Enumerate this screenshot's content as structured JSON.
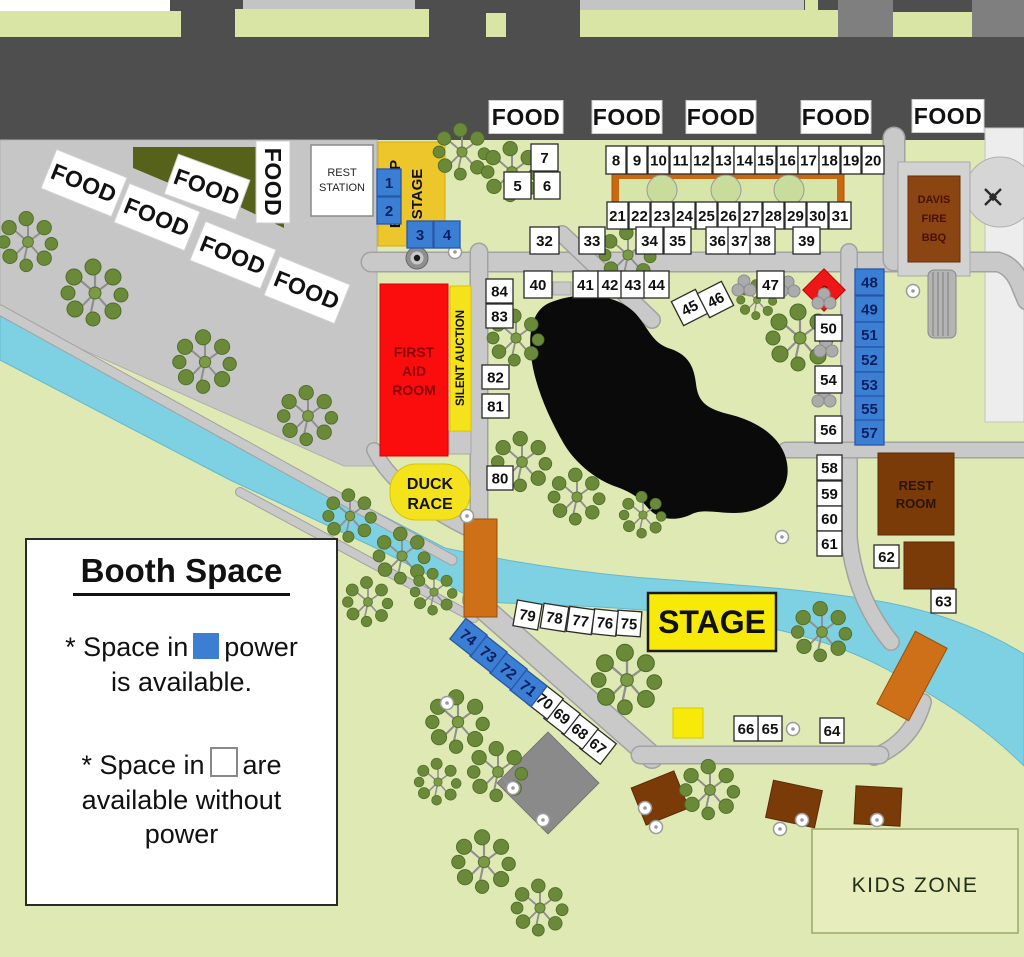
{
  "labels": {
    "food": "FOOD",
    "rest_station_1": "REST",
    "rest_station_2": "STATION",
    "backup_1": "BACK UP",
    "backup_2": "STAGE",
    "first_aid_1": "FIRST",
    "first_aid_2": "AID",
    "first_aid_3": "ROOM",
    "silent_auction": "SILENT AUCTION",
    "duck_1": "DUCK",
    "duck_2": "RACE",
    "stage": "STAGE",
    "rest_room_1": "REST",
    "rest_room_2": "ROOM",
    "davis_1": "DAVIS",
    "davis_2": "FIRE",
    "davis_3": "BBQ",
    "kids_zone": "KIDS ZONE",
    "aid_marker": "AID"
  },
  "legend": {
    "title": "Booth Space",
    "line1a": "* Space in",
    "line1b": "power",
    "line2": "is available.",
    "line3a": "* Space in",
    "line3b": "are",
    "line4": "available without",
    "line5": "power"
  },
  "colors": {
    "booth_power_blue": "#3b7fd4",
    "booth_no_power_white": "#ffffff",
    "stage_yellow": "#f7ea08",
    "backup_stage_yellow": "#edc62c",
    "first_aid_red": "#fb0d0d",
    "river_blue": "#7ed1e2",
    "bridge_orange": "#cd7017",
    "building_brown": "#7b3b09",
    "road_gray": "#c9c9c9",
    "park_green": "#dfe9b3"
  },
  "booths": [
    {
      "n": 1,
      "x": 377,
      "y": 169,
      "w": 24,
      "h": 27,
      "power": true
    },
    {
      "n": 2,
      "x": 377,
      "y": 197,
      "w": 24,
      "h": 27,
      "power": true
    },
    {
      "n": 3,
      "x": 407,
      "y": 221,
      "w": 26,
      "h": 27,
      "power": true
    },
    {
      "n": 4,
      "x": 434,
      "y": 221,
      "w": 26,
      "h": 27,
      "power": true
    },
    {
      "n": 5,
      "x": 504,
      "y": 172,
      "w": 27,
      "h": 27
    },
    {
      "n": 6,
      "x": 534,
      "y": 172,
      "w": 26,
      "h": 27
    },
    {
      "n": 7,
      "x": 531,
      "y": 144,
      "w": 27,
      "h": 27
    },
    {
      "n": 8,
      "x": 606,
      "y": 146,
      "w": 20,
      "h": 28
    },
    {
      "n": 9,
      "x": 627,
      "y": 146,
      "w": 20,
      "h": 28
    },
    {
      "n": 10,
      "x": 648,
      "y": 146,
      "w": 21,
      "h": 28
    },
    {
      "n": 11,
      "x": 670,
      "y": 146,
      "w": 21,
      "h": 28
    },
    {
      "n": 12,
      "x": 691,
      "y": 146,
      "w": 21,
      "h": 28
    },
    {
      "n": 13,
      "x": 713,
      "y": 146,
      "w": 21,
      "h": 28
    },
    {
      "n": 14,
      "x": 734,
      "y": 146,
      "w": 21,
      "h": 28
    },
    {
      "n": 15,
      "x": 755,
      "y": 146,
      "w": 21,
      "h": 28
    },
    {
      "n": 16,
      "x": 777,
      "y": 146,
      "w": 21,
      "h": 28
    },
    {
      "n": 17,
      "x": 798,
      "y": 146,
      "w": 21,
      "h": 28
    },
    {
      "n": 18,
      "x": 819,
      "y": 146,
      "w": 21,
      "h": 28
    },
    {
      "n": 19,
      "x": 841,
      "y": 146,
      "w": 20,
      "h": 28
    },
    {
      "n": 20,
      "x": 862,
      "y": 146,
      "w": 22,
      "h": 28
    },
    {
      "n": 21,
      "x": 607,
      "y": 202,
      "w": 21,
      "h": 27
    },
    {
      "n": 22,
      "x": 629,
      "y": 202,
      "w": 21,
      "h": 27
    },
    {
      "n": 23,
      "x": 651,
      "y": 202,
      "w": 22,
      "h": 27
    },
    {
      "n": 24,
      "x": 674,
      "y": 202,
      "w": 21,
      "h": 27
    },
    {
      "n": 25,
      "x": 696,
      "y": 202,
      "w": 21,
      "h": 27
    },
    {
      "n": 26,
      "x": 718,
      "y": 202,
      "w": 21,
      "h": 27
    },
    {
      "n": 27,
      "x": 740,
      "y": 202,
      "w": 22,
      "h": 27
    },
    {
      "n": 28,
      "x": 763,
      "y": 202,
      "w": 21,
      "h": 27
    },
    {
      "n": 29,
      "x": 785,
      "y": 202,
      "w": 21,
      "h": 27
    },
    {
      "n": 30,
      "x": 807,
      "y": 202,
      "w": 21,
      "h": 27
    },
    {
      "n": 31,
      "x": 829,
      "y": 202,
      "w": 22,
      "h": 27
    },
    {
      "n": 32,
      "x": 530,
      "y": 227,
      "w": 29,
      "h": 27
    },
    {
      "n": 33,
      "x": 579,
      "y": 227,
      "w": 26,
      "h": 27
    },
    {
      "n": 34,
      "x": 636,
      "y": 227,
      "w": 27,
      "h": 27
    },
    {
      "n": 35,
      "x": 664,
      "y": 227,
      "w": 27,
      "h": 27
    },
    {
      "n": 36,
      "x": 706,
      "y": 227,
      "w": 23,
      "h": 27
    },
    {
      "n": 37,
      "x": 728,
      "y": 227,
      "w": 23,
      "h": 27
    },
    {
      "n": 38,
      "x": 750,
      "y": 227,
      "w": 25,
      "h": 27
    },
    {
      "n": 39,
      "x": 793,
      "y": 227,
      "w": 27,
      "h": 27
    },
    {
      "n": 40,
      "x": 524,
      "y": 271,
      "w": 28,
      "h": 27
    },
    {
      "n": 41,
      "x": 573,
      "y": 271,
      "w": 25,
      "h": 27
    },
    {
      "n": 42,
      "x": 598,
      "y": 271,
      "w": 24,
      "h": 27
    },
    {
      "n": 43,
      "x": 621,
      "y": 271,
      "w": 24,
      "h": 27
    },
    {
      "n": 44,
      "x": 644,
      "y": 271,
      "w": 25,
      "h": 27
    },
    {
      "n": 45,
      "x": 676,
      "y": 294,
      "w": 27,
      "h": 27,
      "rot": -27
    },
    {
      "n": 46,
      "x": 702,
      "y": 286,
      "w": 27,
      "h": 27,
      "rot": -27
    },
    {
      "n": 47,
      "x": 757,
      "y": 271,
      "w": 27,
      "h": 27
    },
    {
      "n": 48,
      "x": 855,
      "y": 269,
      "w": 29,
      "h": 26,
      "power": true
    },
    {
      "n": 49,
      "x": 855,
      "y": 296,
      "w": 29,
      "h": 26,
      "power": true
    },
    {
      "n": 50,
      "x": 815,
      "y": 315,
      "w": 27,
      "h": 26
    },
    {
      "n": 51,
      "x": 855,
      "y": 322,
      "w": 29,
      "h": 25,
      "power": true
    },
    {
      "n": 52,
      "x": 855,
      "y": 347,
      "w": 29,
      "h": 25,
      "power": true
    },
    {
      "n": 53,
      "x": 855,
      "y": 372,
      "w": 29,
      "h": 25,
      "power": true
    },
    {
      "n": 54,
      "x": 815,
      "y": 366,
      "w": 27,
      "h": 27
    },
    {
      "n": 55,
      "x": 855,
      "y": 396,
      "w": 29,
      "h": 25,
      "power": true
    },
    {
      "n": 56,
      "x": 815,
      "y": 416,
      "w": 27,
      "h": 27
    },
    {
      "n": 57,
      "x": 855,
      "y": 420,
      "w": 29,
      "h": 25,
      "power": true
    },
    {
      "n": 58,
      "x": 817,
      "y": 455,
      "w": 25,
      "h": 25
    },
    {
      "n": 59,
      "x": 817,
      "y": 481,
      "w": 25,
      "h": 25
    },
    {
      "n": 60,
      "x": 817,
      "y": 506,
      "w": 25,
      "h": 25
    },
    {
      "n": 61,
      "x": 817,
      "y": 531,
      "w": 25,
      "h": 25
    },
    {
      "n": 62,
      "x": 874,
      "y": 545,
      "w": 25,
      "h": 23
    },
    {
      "n": 63,
      "x": 931,
      "y": 589,
      "w": 25,
      "h": 24
    },
    {
      "n": 64,
      "x": 820,
      "y": 718,
      "w": 24,
      "h": 25
    },
    {
      "n": 65,
      "x": 758,
      "y": 716,
      "w": 24,
      "h": 25
    },
    {
      "n": 66,
      "x": 734,
      "y": 716,
      "w": 24,
      "h": 25
    },
    {
      "n": 67,
      "x": 585,
      "y": 733,
      "w": 26,
      "h": 26,
      "rot": 38
    },
    {
      "n": 68,
      "x": 567,
      "y": 718,
      "w": 26,
      "h": 26,
      "rot": 38
    },
    {
      "n": 69,
      "x": 549,
      "y": 703,
      "w": 26,
      "h": 26,
      "rot": 38
    },
    {
      "n": 70,
      "x": 532,
      "y": 688,
      "w": 26,
      "h": 26,
      "rot": 38
    },
    {
      "n": 71,
      "x": 515,
      "y": 675,
      "w": 27,
      "h": 26,
      "rot": 38,
      "power": true
    },
    {
      "n": 72,
      "x": 495,
      "y": 658,
      "w": 27,
      "h": 26,
      "rot": 38,
      "power": true
    },
    {
      "n": 73,
      "x": 475,
      "y": 641,
      "w": 27,
      "h": 26,
      "rot": 38,
      "power": true
    },
    {
      "n": 74,
      "x": 455,
      "y": 624,
      "w": 27,
      "h": 26,
      "rot": 38,
      "power": true
    },
    {
      "n": 75,
      "x": 617,
      "y": 611,
      "w": 24,
      "h": 25,
      "rot": 4
    },
    {
      "n": 76,
      "x": 593,
      "y": 610,
      "w": 24,
      "h": 25,
      "rot": 6
    },
    {
      "n": 77,
      "x": 568,
      "y": 608,
      "w": 25,
      "h": 25,
      "rot": 8
    },
    {
      "n": 78,
      "x": 542,
      "y": 605,
      "w": 25,
      "h": 25,
      "rot": 9
    },
    {
      "n": 79,
      "x": 515,
      "y": 602,
      "w": 25,
      "h": 26,
      "rot": 10
    },
    {
      "n": 80,
      "x": 487,
      "y": 466,
      "w": 26,
      "h": 24
    },
    {
      "n": 81,
      "x": 482,
      "y": 394,
      "w": 27,
      "h": 24
    },
    {
      "n": 82,
      "x": 482,
      "y": 365,
      "w": 27,
      "h": 24
    },
    {
      "n": 83,
      "x": 486,
      "y": 304,
      "w": 27,
      "h": 24
    },
    {
      "n": 84,
      "x": 486,
      "y": 279,
      "w": 27,
      "h": 24
    }
  ],
  "food_signs": [
    {
      "cx": 526,
      "cy": 117,
      "w": 74,
      "h": 33,
      "rot": 0
    },
    {
      "cx": 627,
      "cy": 117,
      "w": 70,
      "h": 33,
      "rot": 0
    },
    {
      "cx": 721,
      "cy": 117,
      "w": 70,
      "h": 33,
      "rot": 0
    },
    {
      "cx": 836,
      "cy": 117,
      "w": 70,
      "h": 33,
      "rot": 0
    },
    {
      "cx": 948,
      "cy": 116,
      "w": 72,
      "h": 33,
      "rot": 0
    },
    {
      "cx": 84,
      "cy": 183,
      "w": 76,
      "h": 42,
      "rot": 22
    },
    {
      "cx": 207,
      "cy": 187,
      "w": 76,
      "h": 42,
      "rot": 20
    },
    {
      "cx": 157,
      "cy": 217,
      "w": 76,
      "h": 42,
      "rot": 22
    },
    {
      "cx": 233,
      "cy": 255,
      "w": 76,
      "h": 42,
      "rot": 22
    },
    {
      "cx": 307,
      "cy": 290,
      "w": 76,
      "h": 42,
      "rot": 22
    },
    {
      "cx": 273,
      "cy": 182,
      "w": 82,
      "h": 34,
      "rot": 90
    }
  ],
  "trees": [
    {
      "x": 28,
      "y": 242,
      "s": 0.9
    },
    {
      "x": 95,
      "y": 293,
      "s": 1.0
    },
    {
      "x": 205,
      "y": 362,
      "s": 0.95
    },
    {
      "x": 308,
      "y": 416,
      "s": 0.9
    },
    {
      "x": 350,
      "y": 516,
      "s": 0.8
    },
    {
      "x": 402,
      "y": 556,
      "s": 0.85
    },
    {
      "x": 368,
      "y": 602,
      "s": 0.75
    },
    {
      "x": 434,
      "y": 592,
      "s": 0.7
    },
    {
      "x": 462,
      "y": 152,
      "s": 0.85
    },
    {
      "x": 512,
      "y": 172,
      "s": 0.9
    },
    {
      "x": 628,
      "y": 255,
      "s": 0.85
    },
    {
      "x": 516,
      "y": 338,
      "s": 0.85
    },
    {
      "x": 522,
      "y": 462,
      "s": 0.9
    },
    {
      "x": 577,
      "y": 497,
      "s": 0.85
    },
    {
      "x": 643,
      "y": 515,
      "s": 0.7
    },
    {
      "x": 800,
      "y": 338,
      "s": 1.0
    },
    {
      "x": 757,
      "y": 300,
      "s": 0.6
    },
    {
      "x": 822,
      "y": 632,
      "s": 0.9
    },
    {
      "x": 627,
      "y": 680,
      "s": 1.05
    },
    {
      "x": 458,
      "y": 722,
      "s": 0.95
    },
    {
      "x": 498,
      "y": 772,
      "s": 0.9
    },
    {
      "x": 438,
      "y": 782,
      "s": 0.7
    },
    {
      "x": 484,
      "y": 862,
      "s": 0.95
    },
    {
      "x": 540,
      "y": 908,
      "s": 0.85
    },
    {
      "x": 710,
      "y": 790,
      "s": 0.9
    }
  ],
  "bushes": [
    {
      "x": 744,
      "y": 287
    },
    {
      "x": 788,
      "y": 288
    },
    {
      "x": 824,
      "y": 300
    },
    {
      "x": 826,
      "y": 348
    },
    {
      "x": 824,
      "y": 398
    }
  ],
  "markers": [
    {
      "x": 455,
      "y": 252
    },
    {
      "x": 467,
      "y": 516
    },
    {
      "x": 447,
      "y": 703
    },
    {
      "x": 513,
      "y": 788
    },
    {
      "x": 543,
      "y": 820
    },
    {
      "x": 645,
      "y": 808
    },
    {
      "x": 656,
      "y": 827
    },
    {
      "x": 780,
      "y": 829
    },
    {
      "x": 802,
      "y": 820
    },
    {
      "x": 877,
      "y": 820
    },
    {
      "x": 793,
      "y": 729
    },
    {
      "x": 913,
      "y": 291
    },
    {
      "x": 782,
      "y": 537
    }
  ]
}
